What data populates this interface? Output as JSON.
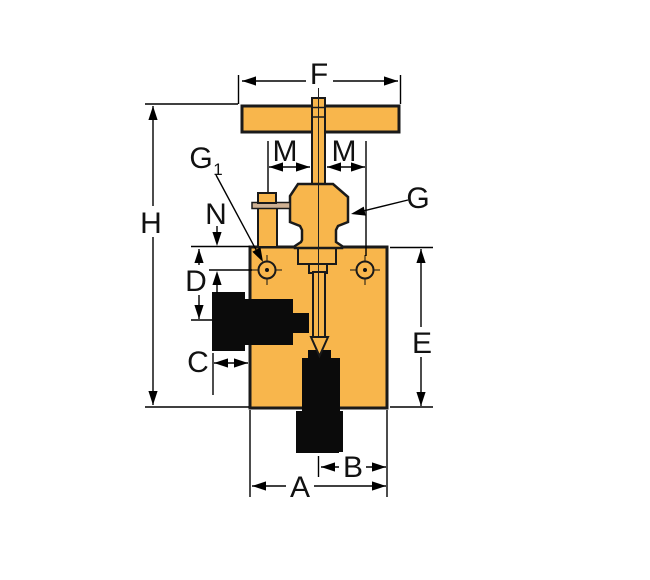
{
  "diagram": {
    "description": "Needle valve dimensional outline drawing",
    "colors": {
      "body_brass": "#F8B64C",
      "flange_tan": "#CFB193",
      "fitting_black": "#0B0B0B",
      "outline": "#1A1A1A",
      "dimension_line": "#000000",
      "background": "#FFFFFF"
    },
    "labels": {
      "f": "F",
      "m_left": "M",
      "m_right": "M",
      "g": "G",
      "g1_main": "G",
      "g1_sub": "1",
      "n": "N",
      "h": "H",
      "d": "D",
      "c": "C",
      "e": "E",
      "b": "B",
      "a": "A"
    }
  }
}
